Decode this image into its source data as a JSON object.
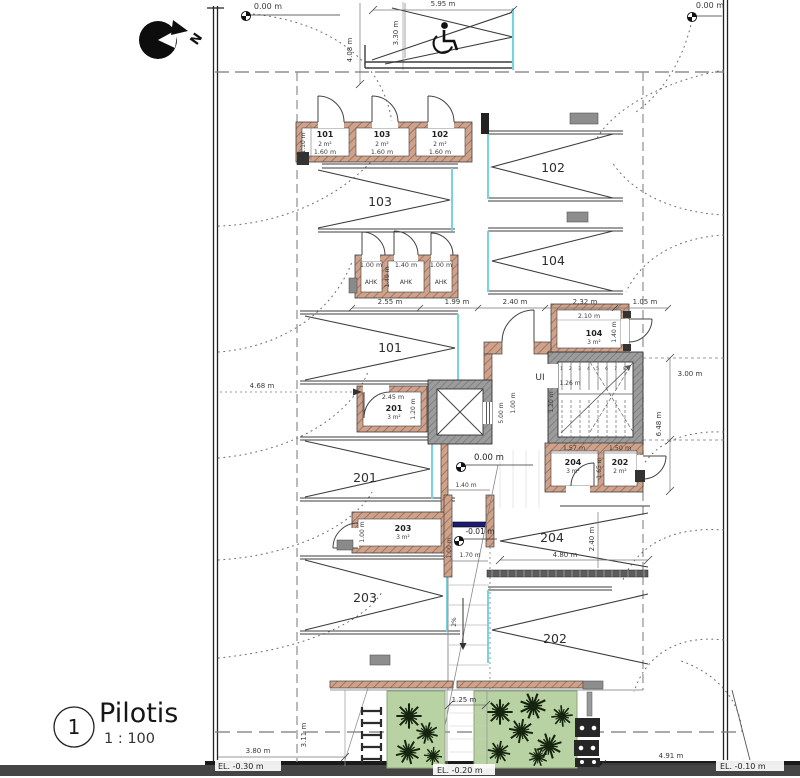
{
  "title_block": {
    "sheet_number": "1",
    "name": "Pilotis",
    "scale": "1 : 100"
  },
  "north_label": "N",
  "elevations": {
    "top_left": "0.00 m",
    "top_right": "0.00 m",
    "lobby": "0.00 m",
    "ramp_top": "-0.01 m",
    "bottom_left": "EL. -0.30 m",
    "bottom_center": "EL. -0.20 m",
    "bottom_right": "EL. -0.10 m"
  },
  "storage_row1": {
    "height_dim": "1.10 m",
    "rooms": [
      {
        "number": "101",
        "area": "2 m²",
        "width": "1.60 m"
      },
      {
        "number": "103",
        "area": "2 m²",
        "width": "1.60 m"
      },
      {
        "number": "102",
        "area": "2 m²",
        "width": "1.60 m"
      }
    ]
  },
  "ahk_row": {
    "depth_dim": "1.40 m",
    "rooms": [
      {
        "label": "AHK",
        "width": "1.00 m"
      },
      {
        "label": "AHK",
        "width": "1.40 m"
      },
      {
        "label": "AHK",
        "width": "1.00 m"
      }
    ]
  },
  "core_rooms": {
    "r104": {
      "number": "104",
      "area": "3 m²",
      "width_dim": "2.10 m",
      "depth_dim": "1.40 m"
    },
    "r201": {
      "number": "201",
      "area": "3 m²",
      "width_dim": "2.45 m",
      "depth_dim": "1.20 m"
    },
    "r204": {
      "number": "204",
      "area": "3 m²",
      "width_dim": "1.57 m"
    },
    "r202": {
      "number": "202",
      "area": "2 m²",
      "width_dim": "1.50 m",
      "depth_dim": "1.65 m"
    },
    "r203": {
      "number": "203",
      "area": "3 m²",
      "depth_dim": "1.00 m"
    }
  },
  "parking": {
    "p101": "101",
    "p102": "102",
    "p103": "103",
    "p104": "104",
    "p201": "201",
    "p202": "202",
    "p203": "203",
    "p204": "204"
  },
  "stair": {
    "name": "UI",
    "tread_numbers": "1 2 3 4 5 6 7 8",
    "run_dim": "1.26 m",
    "flight_width_dim": "1.20 m"
  },
  "ramp": {
    "slope": "2%",
    "top_width_dim": "1.40 m",
    "bottom_width_dim": "1.70 m",
    "side_dim": "1.00 m"
  },
  "dims": {
    "stall_width": "5.95 m",
    "stall_depth": "3.30 m",
    "top_setback": "4.08 m",
    "chain": [
      "2.55 m",
      "1.99 m",
      "2.40 m",
      "2.32 m",
      "1.05 m"
    ],
    "left_offset": "4.68 m",
    "stair_width": "3.00 m",
    "core_depth": "6.48 m",
    "elev_side": "5.00 m",
    "elev_gap": "1.00 m",
    "stall204_width": "4.80 m",
    "stall204_depth": "2.40 m",
    "walkway": "1.25 m",
    "bottom_left": "3.80 m",
    "bottom_left_v": "3.11 m",
    "bottom_right": "4.91 m"
  },
  "colors": {
    "wall_brown": "#cfa28c",
    "wall_gray": "#9c9c9c",
    "planting_green": "#b9d2a3",
    "stall_entry_cyan": "#79d2e2",
    "drain_navy": "#1c1c77"
  }
}
